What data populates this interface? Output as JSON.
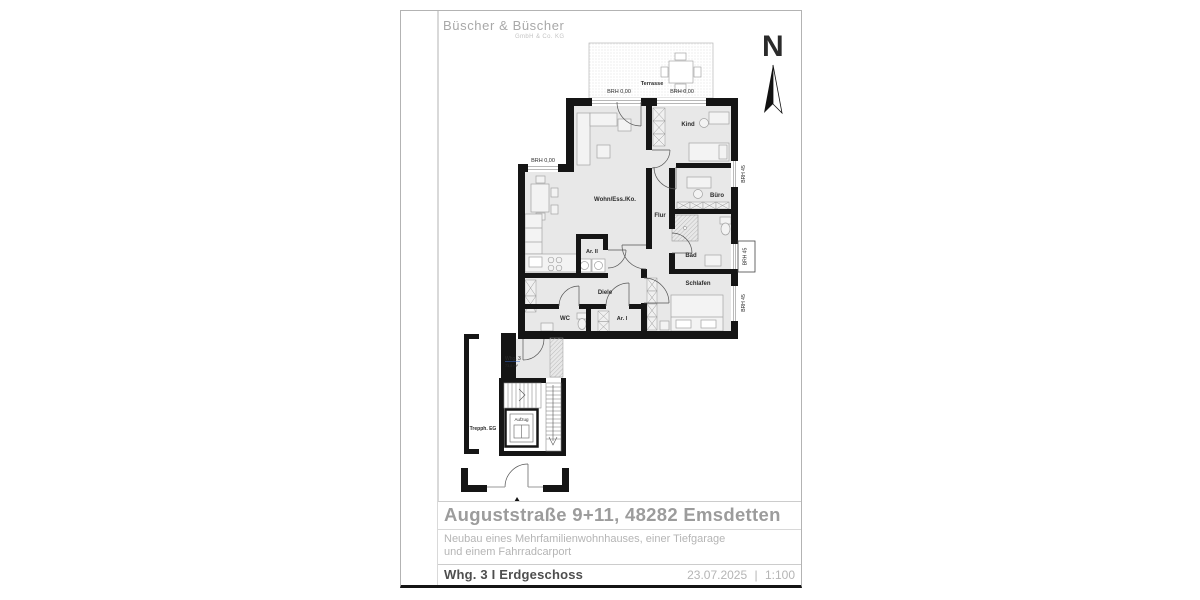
{
  "sheet": {
    "logo_name": "Büscher & Büscher",
    "logo_sub": "GmbH & Co. KG",
    "north": "N"
  },
  "plan": {
    "rooms": {
      "terrasse": "Terrasse",
      "kind": "Kind",
      "buero": "Büro",
      "flur": "Flur",
      "bad": "Bad",
      "schlafen": "Schlafen",
      "wohn": "Wohn/Ess./Ko.",
      "ar2": "Ar. II",
      "ar1": "Ar. I",
      "diele": "Diele",
      "wc": "WC",
      "trepphaus": "Trepph. EG",
      "aufzug": "Aufzug"
    },
    "labels": {
      "brh000": "BRH 0,00",
      "brh45": "BRH 45",
      "whg": "Whg. 3",
      "whg_area": "73,8 m²"
    },
    "colors": {
      "wall": "#151515",
      "floor": "#e8e8e8",
      "apartment_tag": "#3a6bc9"
    }
  },
  "title_block": {
    "address": "Auguststraße 9+11, 48282 Emsdetten",
    "project_line1": "Neubau eines Mehrfamilienwohnhauses, einer Tiefgarage",
    "project_line2": "und einem Fahrradcarport",
    "unit": "Whg. 3 I Erdgeschoss",
    "date": "23.07.2025",
    "separator": "|",
    "scale": "1:100"
  }
}
